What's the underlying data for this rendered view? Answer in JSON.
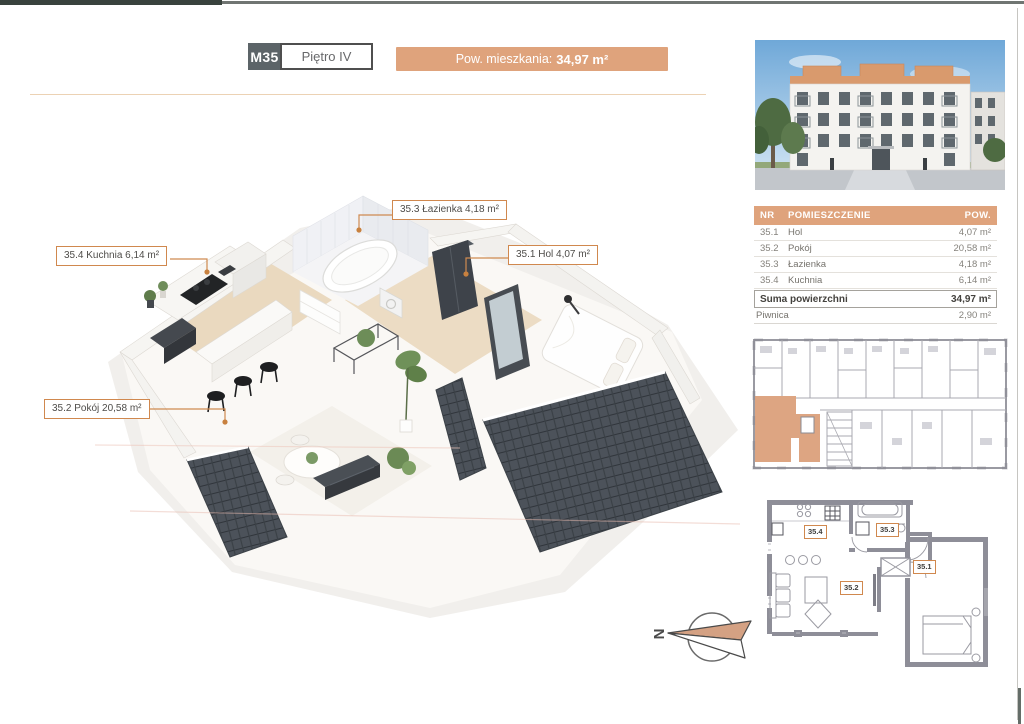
{
  "header": {
    "unit": "M35",
    "floor": "Piętro IV",
    "area_label": "Pow. mieszkania:",
    "area_value": "34,97 m²"
  },
  "plan_labels": {
    "lazienka": "35.3 Łazienka 4,18 m²",
    "kuchnia": "35.4 Kuchnia 6,14 m²",
    "hol": "35.1 Hol 4,07 m²",
    "pokoj": "35.2 Pokój 20,58 m²"
  },
  "table": {
    "headers": [
      "NR",
      "POMIESZCZENIE",
      "POW."
    ],
    "rows": [
      {
        "nr": "35.1",
        "name": "Hol",
        "area": "4,07 m²"
      },
      {
        "nr": "35.2",
        "name": "Pokój",
        "area": "20,58 m²"
      },
      {
        "nr": "35.3",
        "name": "Łazienka",
        "area": "4,18 m²"
      },
      {
        "nr": "35.4",
        "name": "Kuchnia",
        "area": "6,14 m²"
      }
    ],
    "summary_label": "Suma powierzchni",
    "summary_value": "34,97 m²",
    "basement_label": "Piwnica",
    "basement_value": "2,90 m²"
  },
  "unit_plan_labels": {
    "kuchnia": "35.4",
    "lazienka": "35.3",
    "hol": "35.1",
    "pokoj": "35.2"
  },
  "compass": {
    "north": "N"
  },
  "colors": {
    "accent": "#dfa37c",
    "label_border": "#d0884e",
    "roof": "#4c525a",
    "wall_gray": "#8e8e98"
  }
}
